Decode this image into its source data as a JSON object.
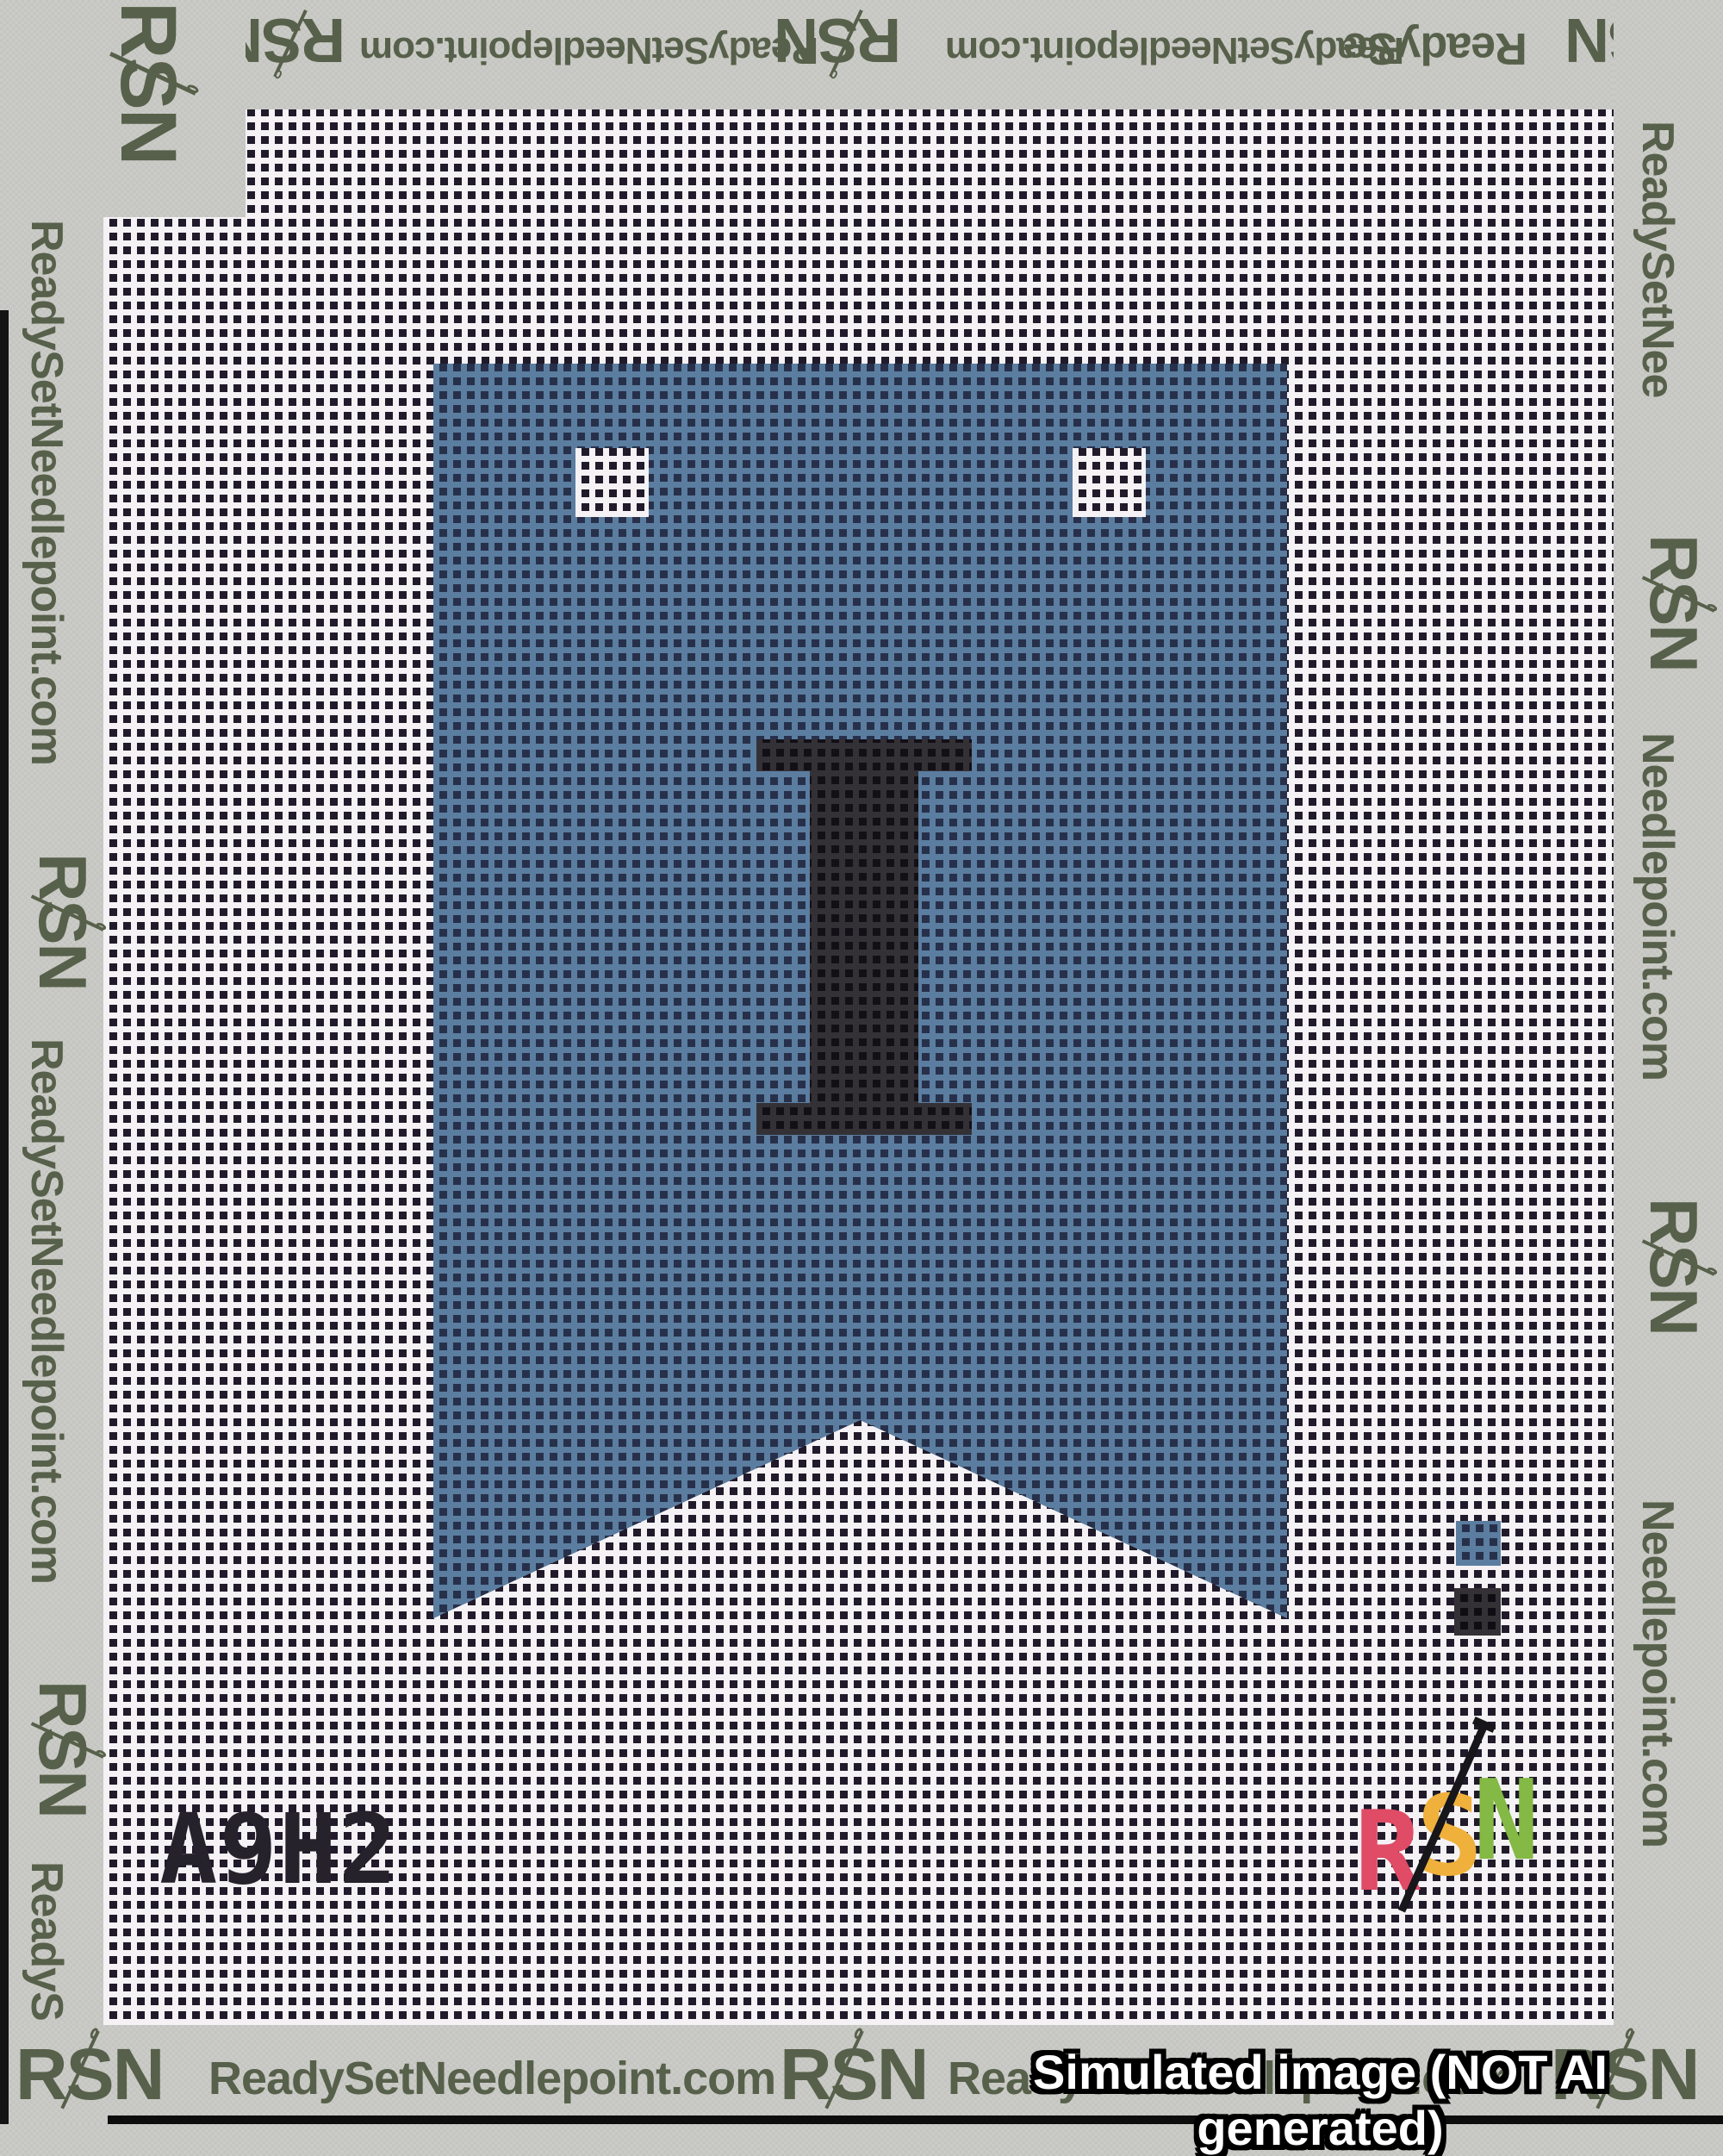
{
  "tape": {
    "brand": "RSN",
    "brand_rs": "RS",
    "brand_n": "N",
    "url_text": "ReadySetNeedlepoint.com",
    "fragments": {
      "ready_se": "ReadySe",
      "ready_set_nee": "ReadySetNee",
      "needlepoint_com": "Needlepoint.com"
    }
  },
  "banner": {
    "letter": "I",
    "shape": "swallowtail pennant",
    "blue_hex": "#5b7da0",
    "letter_hex": "#2e2c2f"
  },
  "sku": {
    "code": "A9H2"
  },
  "color_key": {
    "swatches": [
      {
        "name": "banner-blue",
        "hex": "#5b7da0"
      },
      {
        "name": "letter-black",
        "hex": "#2b292e"
      }
    ]
  },
  "stitched_logo": {
    "r": "R",
    "s": "S",
    "n": "N",
    "r_hex": "#e04b66",
    "s_hex": "#efb13c",
    "n_hex": "#83b944",
    "needle_hex": "#17161a"
  },
  "watermark": {
    "text": "Simulated image (NOT AI generated)"
  }
}
